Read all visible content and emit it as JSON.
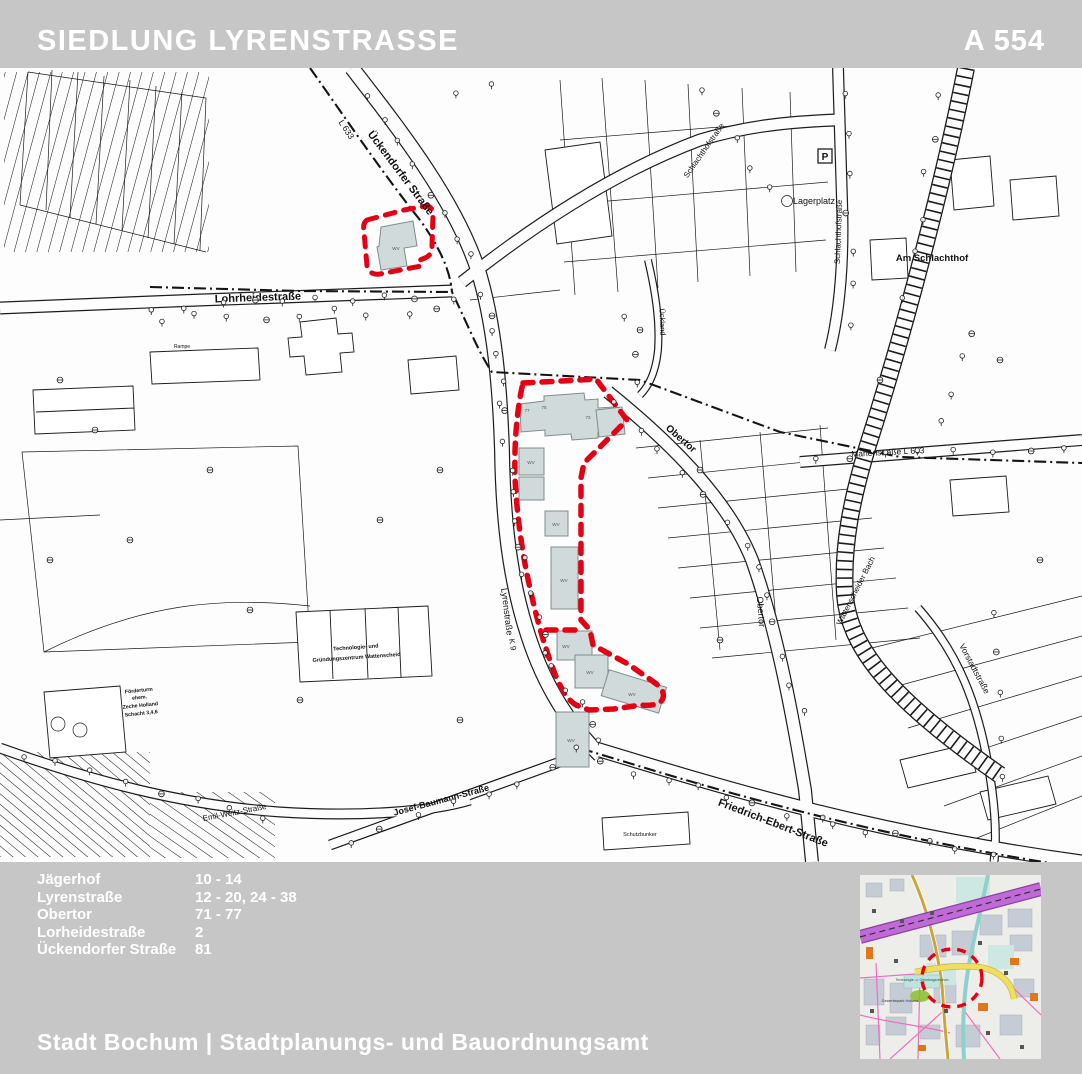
{
  "header": {
    "title": "SIEDLUNG LYRENSTRASSE",
    "code": "A 554"
  },
  "addresses": [
    {
      "street": "Jägerhof",
      "numbers": "10 - 14"
    },
    {
      "street": "Lyrenstraße",
      "numbers": "12 - 20, 24 - 38"
    },
    {
      "street": "Obertor",
      "numbers": "71 - 77"
    },
    {
      "street": "Lorheidestraße",
      "numbers": "2"
    },
    {
      "street": "Ückendorfer Straße",
      "numbers": "81"
    }
  ],
  "footer": {
    "title": "Stadt Bochum  |  Stadtplanungs- und Bauordnungsamt"
  },
  "map": {
    "street_labels": [
      {
        "text": "Ückendorfer Straße"
      },
      {
        "text": "L 633"
      },
      {
        "text": "Lohrheidestraße"
      },
      {
        "text": "Lyrenstraße"
      },
      {
        "text": "K 9"
      },
      {
        "text": "Obertor"
      },
      {
        "text": "Obertor"
      },
      {
        "text": "Marienstraße  L 633"
      },
      {
        "text": "Wattenscheider Bach"
      },
      {
        "text": "Vorstadtstraße"
      },
      {
        "text": "Friedrich-Ebert-Straße"
      },
      {
        "text": "Josef-Baumann-Straße"
      },
      {
        "text": "Emil-Weitz-Straße"
      },
      {
        "text": "Schlachthofstraße"
      },
      {
        "text": "Schlachthofstraße"
      },
      {
        "text": "Ückland"
      }
    ],
    "area_labels": {
      "am_schlachthof": "Am Schlachthof",
      "lagerplatz": "Lagerplatz",
      "parking": "P",
      "rampe": "Rampe",
      "schutzbunker": "Schutzbunker",
      "tech_line1": "Technologie- und",
      "tech_line2": "Gründungszentrum Wattenscheid",
      "zeche_line1": "Förderturm",
      "zeche_line2": "ehem.",
      "zeche_line3": "Zeche Holland",
      "zeche_line4": "Schacht 3,4,6"
    },
    "building_labels": [
      "77",
      "75",
      "73",
      "WV",
      "WV",
      "WV",
      "WV",
      "WV",
      "WV",
      "WV",
      "WV"
    ]
  },
  "minimap": {
    "labels": [
      "Gewerbepark Holland",
      "Technologie- u. Gründungszentrum"
    ]
  },
  "colors": {
    "page_gray": "#c6c6c6",
    "boundary_red": "#e60013",
    "building_fill": "#d0dada",
    "rail_purple": "#c06ad8",
    "road_yellow": "#f0df5e"
  }
}
